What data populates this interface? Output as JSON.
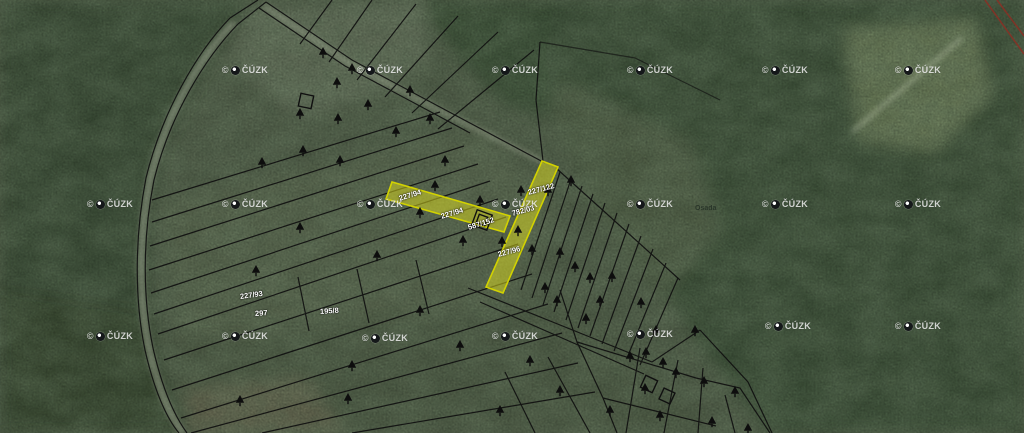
{
  "map": {
    "kind": "cadastral-parcel-overlay-on-aerial-imagery",
    "attribution": "© ČÚZK",
    "colors": {
      "parcel_line": "#101010",
      "highlight_fill": "#d8d81e",
      "highlight_stroke": "#cfcf00",
      "watermark_text": "#ffffff",
      "red_boundary": "#8b2f24",
      "forest": "#3d5238",
      "field": "#68765a"
    }
  },
  "watermarks": {
    "prefix": "©",
    "text": "ČÚZK",
    "positions": [
      [
        245,
        70
      ],
      [
        380,
        70
      ],
      [
        515,
        70
      ],
      [
        650,
        70
      ],
      [
        785,
        70
      ],
      [
        918,
        70
      ],
      [
        110,
        204
      ],
      [
        245,
        204
      ],
      [
        380,
        204
      ],
      [
        515,
        204
      ],
      [
        650,
        204
      ],
      [
        785,
        204
      ],
      [
        918,
        204
      ],
      [
        110,
        336
      ],
      [
        245,
        336
      ],
      [
        385,
        338
      ],
      [
        515,
        336
      ],
      [
        650,
        334
      ],
      [
        788,
        326
      ],
      [
        918,
        326
      ]
    ]
  },
  "parcel_labels": [
    {
      "text": "227/94",
      "x": 399,
      "y": 194,
      "rot": -17,
      "style": "light"
    },
    {
      "text": "227/94",
      "x": 441,
      "y": 212,
      "rot": -17,
      "style": "light"
    },
    {
      "text": "587/152",
      "x": 468,
      "y": 223,
      "rot": -17,
      "style": "light"
    },
    {
      "text": "227/122",
      "x": 528,
      "y": 188,
      "rot": -15,
      "style": "light"
    },
    {
      "text": "782/03",
      "x": 512,
      "y": 209,
      "rot": -15,
      "style": "light"
    },
    {
      "text": "227/96",
      "x": 498,
      "y": 250,
      "rot": -15,
      "style": "light"
    },
    {
      "text": "227/93",
      "x": 240,
      "y": 292,
      "rot": -8,
      "style": "light"
    },
    {
      "text": "297",
      "x": 255,
      "y": 309,
      "rot": -4,
      "style": "light"
    },
    {
      "text": "195/8",
      "x": 320,
      "y": 307,
      "rot": -4,
      "style": "light"
    },
    {
      "text": "Osada",
      "x": 695,
      "y": 205,
      "rot": 0,
      "style": "dark"
    }
  ],
  "highlighted_parcels": [
    "227/94",
    "587/152",
    "227/122",
    "782/03",
    "227/96"
  ],
  "trees": [
    [
      323,
      52
    ],
    [
      352,
      68
    ],
    [
      337,
      82
    ],
    [
      410,
      90
    ],
    [
      368,
      104
    ],
    [
      300,
      113
    ],
    [
      338,
      118
    ],
    [
      430,
      118
    ],
    [
      396,
      131
    ],
    [
      445,
      160
    ],
    [
      340,
      160
    ],
    [
      303,
      150
    ],
    [
      262,
      162
    ],
    [
      435,
      185
    ],
    [
      480,
      200
    ],
    [
      521,
      190
    ],
    [
      548,
      190
    ],
    [
      420,
      212
    ],
    [
      463,
      240
    ],
    [
      502,
      241
    ],
    [
      518,
      230
    ],
    [
      532,
      249
    ],
    [
      560,
      252
    ],
    [
      575,
      266
    ],
    [
      590,
      277
    ],
    [
      545,
      287
    ],
    [
      557,
      300
    ],
    [
      600,
      300
    ],
    [
      612,
      276
    ],
    [
      641,
      302
    ],
    [
      656,
      330
    ],
    [
      630,
      356
    ],
    [
      646,
      352
    ],
    [
      663,
      362
    ],
    [
      676,
      372
    ],
    [
      704,
      381
    ],
    [
      735,
      391
    ],
    [
      645,
      388
    ],
    [
      712,
      421
    ],
    [
      748,
      428
    ],
    [
      256,
      270
    ],
    [
      352,
      365
    ],
    [
      240,
      400
    ],
    [
      348,
      398
    ],
    [
      420,
      310
    ],
    [
      377,
      255
    ],
    [
      300,
      227
    ],
    [
      460,
      345
    ],
    [
      530,
      360
    ],
    [
      560,
      390
    ],
    [
      500,
      410
    ],
    [
      610,
      410
    ],
    [
      660,
      415
    ],
    [
      695,
      330
    ],
    [
      586,
      318
    ],
    [
      571,
      180
    ]
  ]
}
